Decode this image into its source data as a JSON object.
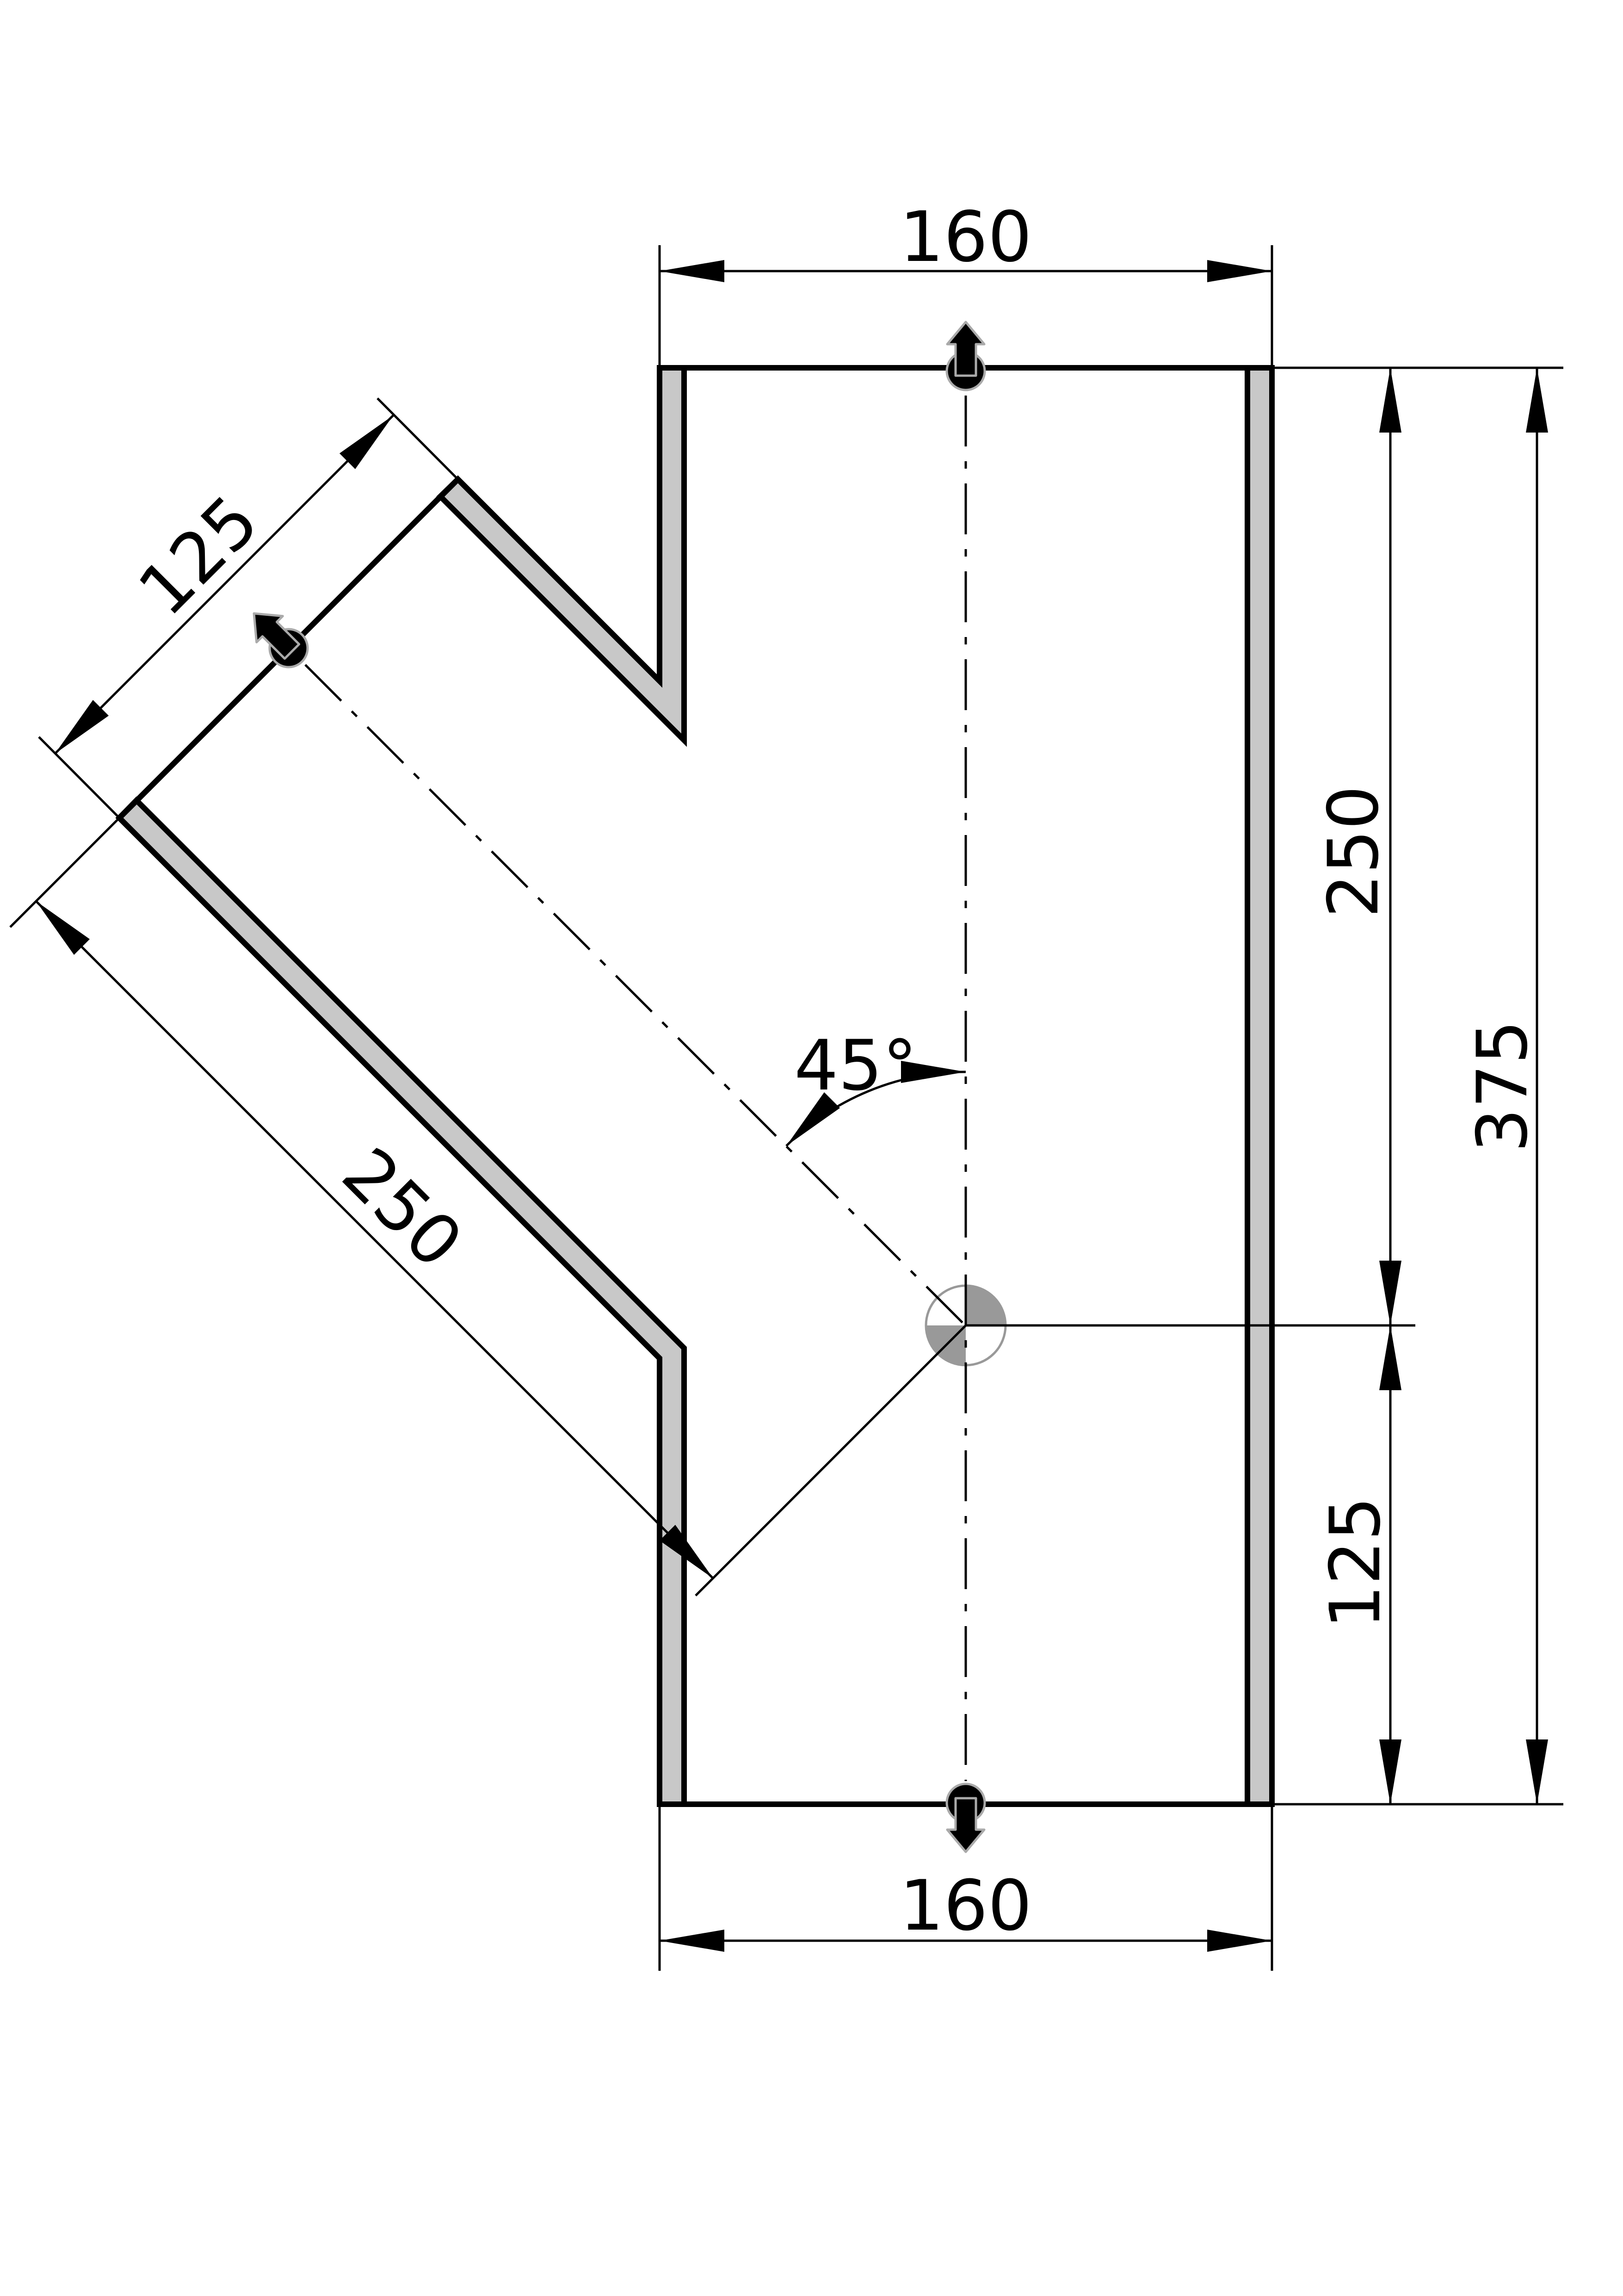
{
  "drawing": {
    "labels": {
      "top_width": "160",
      "bottom_width": "160",
      "branch_width": "125",
      "branch_length": "250",
      "branch_angle": "45°",
      "height_upper": "250",
      "height_lower": "125",
      "height_total": "375"
    },
    "colors": {
      "line": "#000000",
      "wall_fill": "#c8c8c8",
      "center_mark_gray": "#999999",
      "flow_arrow_fill": "#000000",
      "flow_arrow_outline": "#aaaaaa",
      "background": "#ffffff"
    },
    "icons": {
      "flow_symbol": "flow-direction-arrow",
      "center_symbol": "center-mark"
    }
  }
}
